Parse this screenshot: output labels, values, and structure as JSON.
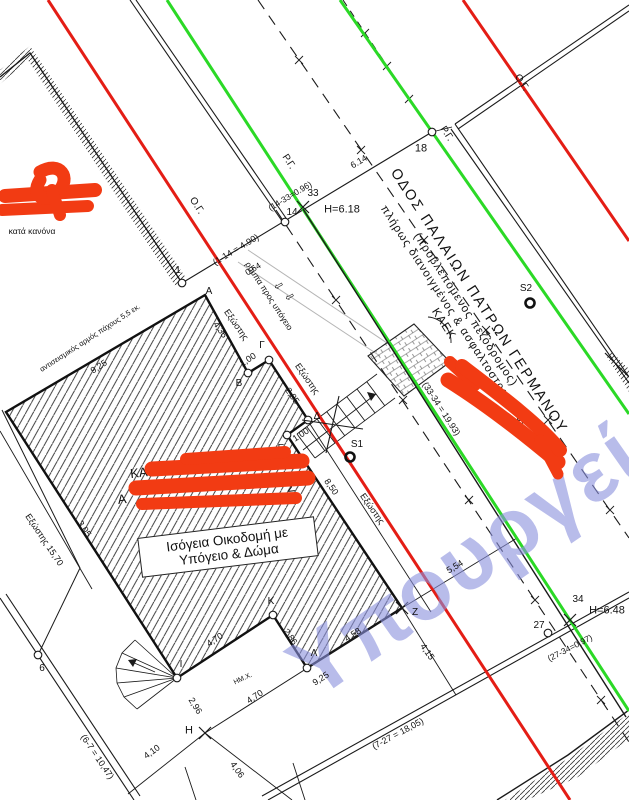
{
  "drawing": {
    "title": "Τοπογραφικό διάγραμμα",
    "colors": {
      "building_line_red": "#e41d15",
      "street_line_green": "#2bd926",
      "redaction": "#f23b13",
      "watermark": "#8a90dd"
    },
    "watermark_text": "Υπουργείο",
    "street_block": {
      "line1": "ΟΔΟΣ ΠΑΛΑΙΩΝ ΠΑΤΡΩΝ ΓΕΡΜΑΝΟΥ",
      "line2": "(προβλεπόμενος πεζόδρομος)",
      "line3": "πλήρως διανοιγμένος & ασφαλτοστρωμένος",
      "line4": "ΚΑΕΚ"
    },
    "building_box": {
      "line1": "Ισόγεια Οικοδομή με",
      "line2": "Υπόγειο & Δώμα"
    },
    "redacted_fragments": {
      "kaek_partial": "ΚΑΕΚ : 06",
      "second_line_start": "Α",
      "second_line_end": "Σ",
      "top_left_digit": "3",
      "top_left_note": "κατά κανόνα"
    },
    "labels": [
      [
        "Ο.Γ.",
        196,
        206,
        57,
        10
      ],
      [
        "Ο.Γ.",
        521,
        83,
        57,
        10
      ],
      [
        "Ρ.Γ.",
        288,
        162,
        57,
        10
      ],
      [
        "Ρ.Γ.",
        446,
        134,
        57,
        10
      ],
      [
        "(1-14 = 4.90)",
        236,
        250,
        -31,
        9
      ],
      [
        "0,54",
        253,
        269,
        -31,
        8.5
      ],
      [
        "(14-33=0.96)",
        290,
        196,
        -31,
        8.5
      ],
      [
        "14",
        292,
        213,
        0,
        10
      ],
      [
        "33",
        313,
        194,
        0,
        10
      ],
      [
        "H=6.18",
        342,
        210,
        0,
        11
      ],
      [
        "6.14",
        359,
        162,
        -31,
        9
      ],
      [
        "18",
        421,
        149,
        0,
        11
      ],
      [
        "S2",
        526,
        289,
        0,
        10
      ],
      [
        "S1",
        357,
        445,
        0,
        10
      ],
      [
        "34",
        578,
        600,
        0,
        10
      ],
      [
        "27",
        539,
        626,
        0,
        10
      ],
      [
        "H=6.48",
        607,
        611,
        0,
        11
      ],
      [
        "(27-34=0,97)",
        570,
        648,
        -27,
        8.5
      ],
      [
        "(33-34 = 19.93)",
        441,
        409,
        57,
        9
      ],
      [
        "(7-27 = 18,05)",
        398,
        734,
        -28,
        9
      ],
      [
        "(6-7 = 10,47)",
        97,
        757,
        56,
        9
      ],
      [
        "6",
        42,
        669,
        0,
        10
      ],
      [
        "Η",
        189,
        731,
        0,
        11
      ],
      [
        "4,10",
        152,
        752,
        -36,
        9
      ],
      [
        "4,06",
        237,
        770,
        55,
        9
      ],
      [
        "2,96",
        195,
        706,
        58,
        9
      ],
      [
        "4,70",
        215,
        640,
        -33,
        9
      ],
      [
        "4,70",
        255,
        697,
        -33,
        9
      ],
      [
        "9,25",
        321,
        679,
        -33,
        9
      ],
      [
        "4,58",
        353,
        635,
        -33,
        9
      ],
      [
        "2,86",
        290,
        637,
        55,
        9
      ],
      [
        "ΗΜ.Χ.",
        243,
        679,
        -25,
        7
      ],
      [
        "5,54",
        455,
        567,
        -31,
        9
      ],
      [
        "4,15",
        427,
        652,
        55,
        9
      ],
      [
        "8,50",
        331,
        487,
        55,
        9
      ],
      [
        "Εξώστης",
        372,
        509,
        55,
        9
      ],
      [
        "Εξώστης",
        236,
        325,
        55,
        9
      ],
      [
        "4,35",
        220,
        330,
        55,
        9
      ],
      [
        "1,00",
        248,
        360,
        -33,
        9
      ],
      [
        "Εξώστης",
        307,
        379,
        55,
        9
      ],
      [
        "2,85",
        292,
        396,
        55,
        9
      ],
      [
        "1,00",
        301,
        435,
        -33,
        9
      ],
      [
        "Ε",
        281,
        449,
        0,
        10
      ],
      [
        "Δ",
        317,
        417,
        0,
        10
      ],
      [
        "Γ",
        262,
        346,
        0,
        10
      ],
      [
        "Β",
        239,
        384,
        0,
        10
      ],
      [
        "Α",
        209,
        292,
        0,
        10
      ],
      [
        "1",
        178,
        271,
        0,
        10
      ],
      [
        "Κ",
        271,
        602,
        0,
        10
      ],
      [
        "Λ",
        314,
        654,
        0,
        10
      ],
      [
        "Ι",
        181,
        665,
        0,
        10
      ],
      [
        "Ζ",
        415,
        613,
        0,
        10
      ],
      [
        "ράμπα προς υπόγειο",
        269,
        296,
        57,
        8.5
      ],
      [
        "αντισεισμικός αρμός πάχους 5,5 εκ.",
        90,
        338,
        -33,
        7.5
      ],
      [
        "9,25",
        99,
        367,
        -33,
        9
      ],
      [
        "Εξώστης 15,70",
        44,
        540,
        56,
        9
      ],
      [
        "3,05",
        84,
        529,
        56,
        9
      ],
      [
        "κατά κανόνα",
        32,
        231,
        0,
        8.5
      ],
      [
        "3",
        46,
        197,
        0,
        12
      ],
      [
        "⇧",
        280,
        285,
        -120,
        11
      ],
      [
        "⇧",
        291,
        296,
        -120,
        11
      ],
      [
        "ΚΑΕΚ : 06",
        160,
        470,
        -7,
        13
      ],
      [
        "Α",
        122,
        499,
        -7,
        13
      ],
      [
        "Σ",
        291,
        487,
        -7,
        13
      ]
    ]
  }
}
